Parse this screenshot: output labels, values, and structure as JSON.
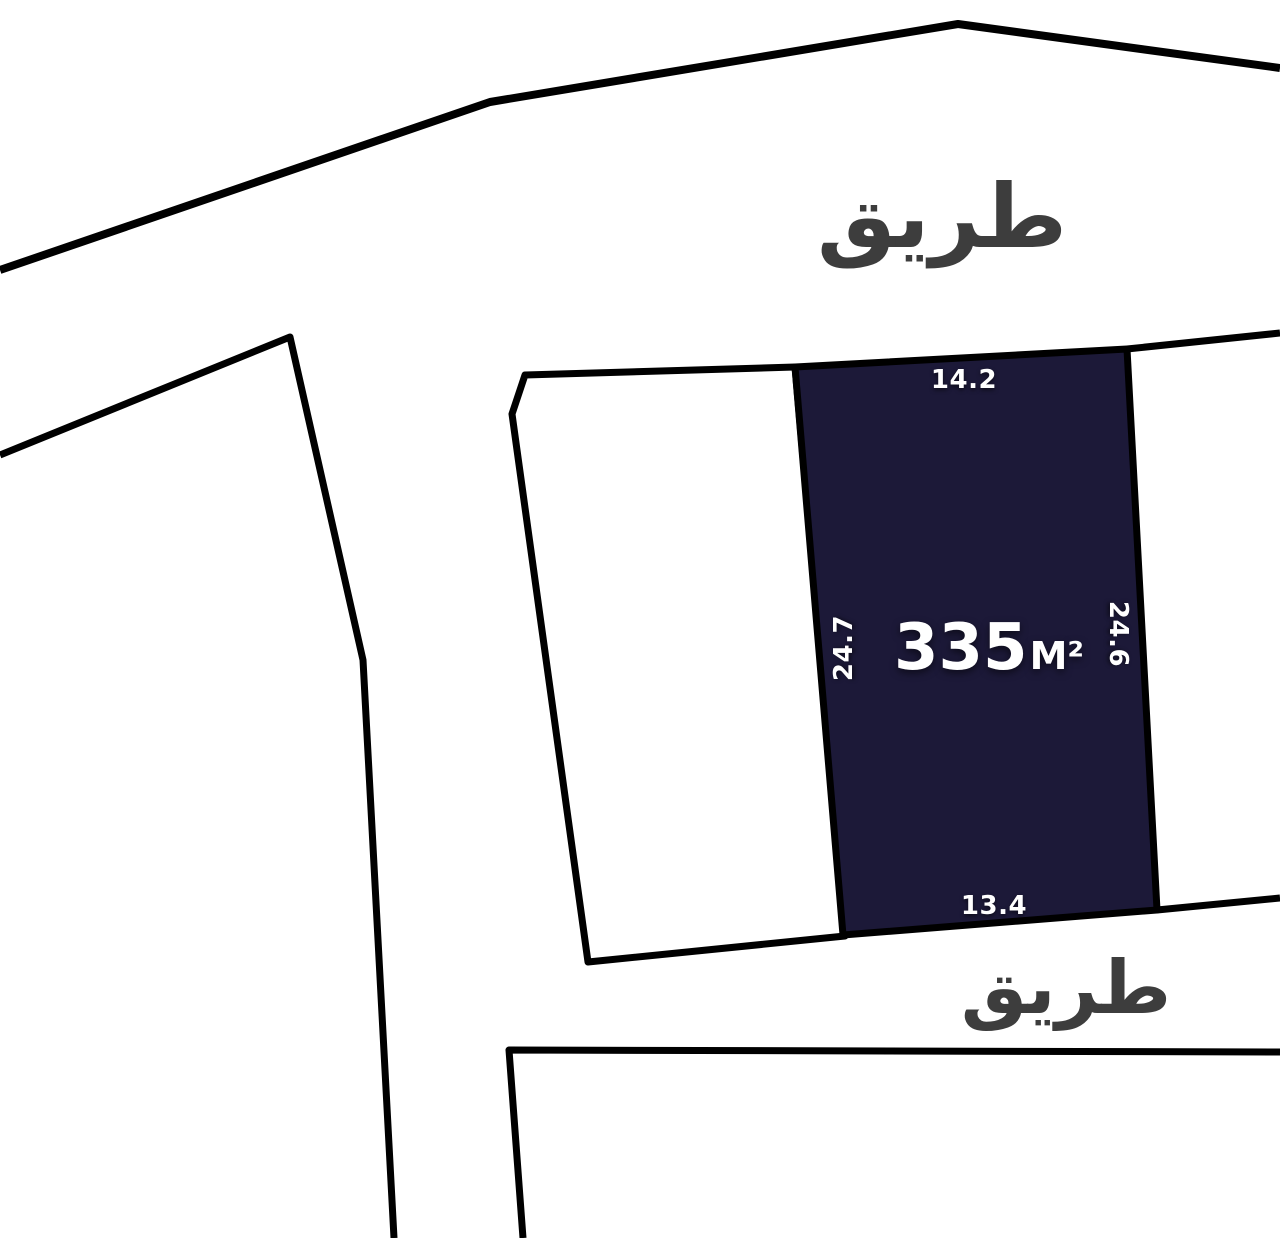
{
  "map": {
    "background_color": "#ffffff",
    "line_color": "#000000",
    "road_label_color": "#3d3d3d",
    "roads": {
      "top_label": "طريق",
      "bottom_label": "طريق"
    },
    "parcel": {
      "fill_color": "#1c1938",
      "area_value": "335",
      "area_unit": "M²",
      "dimensions": {
        "top": "14.2",
        "left": "24.7",
        "right": "24.6",
        "bottom": "13.4"
      }
    },
    "geometry": {
      "canvas_width": 1280,
      "canvas_height": 1238,
      "top_road_line": [
        [
          0,
          270
        ],
        [
          490,
          102
        ],
        [
          958,
          24
        ],
        [
          1280,
          68
        ]
      ],
      "left_parcel_outline": [
        [
          0,
          455
        ],
        [
          290,
          337
        ],
        [
          363,
          660
        ],
        [
          394,
          1238
        ]
      ],
      "middle_parcel": [
        [
          525,
          375
        ],
        [
          795,
          367
        ],
        [
          845,
          936
        ],
        [
          588,
          962
        ],
        [
          512,
          414
        ]
      ],
      "main_parcel": [
        [
          795,
          367
        ],
        [
          1127,
          349
        ],
        [
          1157,
          910
        ],
        [
          843,
          935
        ]
      ],
      "right_boundary_top": [
        [
          1127,
          349
        ],
        [
          1280,
          333
        ]
      ],
      "right_boundary_bottom": [
        [
          1157,
          910
        ],
        [
          1280,
          898
        ]
      ],
      "bottom_parcel_outline": [
        [
          523,
          1238
        ],
        [
          509,
          1050
        ],
        [
          1280,
          1052
        ]
      ]
    },
    "label_positions": {
      "top_road": {
        "x": 942,
        "y": 217
      },
      "bottom_road": {
        "x": 1066,
        "y": 988
      },
      "dim_top": {
        "x": 964,
        "y": 380
      },
      "dim_left": {
        "x": 844,
        "y": 648
      },
      "dim_right": {
        "x": 1118,
        "y": 634
      },
      "dim_bottom": {
        "x": 994,
        "y": 906
      },
      "area": {
        "x": 989,
        "y": 648
      }
    }
  }
}
